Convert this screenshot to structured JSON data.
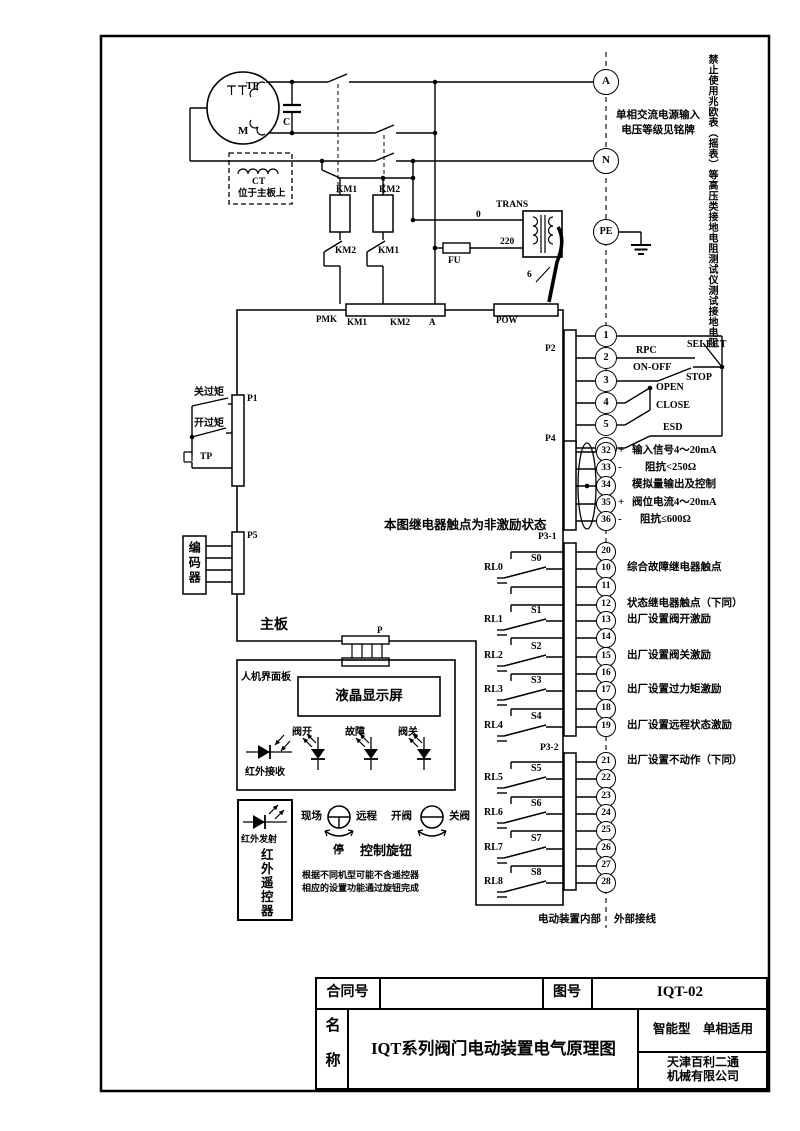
{
  "diagram": {
    "warning_vertical": "禁止使用兆欧表（摇表）等高压类接地电阻测试仪测试接地电阻",
    "supply_line1": "单相交流电源输入",
    "supply_line2": "电压等级见铭牌",
    "relay_state_note": "本图继电器触点为非激励状态",
    "internal_label": "电动装置内部",
    "external_label": "外部接线"
  },
  "terminals_top": {
    "a": "A",
    "n": "N",
    "pe": "PE"
  },
  "motor": {
    "tp": "TP",
    "m": "M",
    "c": "C",
    "ct": "CT",
    "ct_note": "位于主板上"
  },
  "contactors": {
    "km1_coil": "KM1",
    "km2_coil": "KM2",
    "km1_nc": "KM2",
    "km2_nc": "KM1"
  },
  "power": {
    "fu": "FU",
    "tap_0": "0",
    "tap_220": "220",
    "trans": "TRANS",
    "wire_count": "6",
    "pmk": "PMK",
    "pmk_t1": "KM1",
    "pmk_t2": "KM2",
    "pmk_t3": "A",
    "pow": "POW"
  },
  "torque": {
    "p1": "P1",
    "close_torque": "关过矩",
    "open_torque": "开过矩",
    "tp": "TP"
  },
  "encoder": {
    "p5": "P5",
    "name": "编码器"
  },
  "mainboard_label": "主板",
  "p2": {
    "label": "P2",
    "terminals": [
      "1",
      "2",
      "3",
      "4",
      "5",
      "6"
    ],
    "rpc": "RPC",
    "select": "SELECT",
    "on_off": "ON-OFF",
    "stop": "STOP",
    "open": "OPEN",
    "close": "CLOSE",
    "esd": "ESD"
  },
  "p4": {
    "label": "P4",
    "terminals": [
      {
        "num": "32",
        "sign": "+",
        "desc": "输入信号4～20mA"
      },
      {
        "num": "33",
        "sign": "-",
        "desc": "阻抗<250Ω"
      },
      {
        "num": "34",
        "sign": "",
        "desc": "模拟量输出及控制"
      },
      {
        "num": "35",
        "sign": "+",
        "desc": "阀位电流4～20mA"
      },
      {
        "num": "36",
        "sign": "-",
        "desc": "阻抗≤600Ω"
      }
    ]
  },
  "p31": {
    "label": "P3-1",
    "terminals": [
      {
        "num": "20",
        "desc": ""
      },
      {
        "num": "10",
        "desc": "综合故障继电器触点"
      },
      {
        "num": "11",
        "desc": ""
      },
      {
        "num": "12",
        "desc": "状态继电器触点（下同）"
      },
      {
        "num": "13",
        "desc": "出厂设置阀开激励"
      },
      {
        "num": "14",
        "desc": ""
      },
      {
        "num": "15",
        "desc": "出厂设置阀关激励"
      },
      {
        "num": "16",
        "desc": ""
      },
      {
        "num": "17",
        "desc": "出厂设置过力矩激励"
      },
      {
        "num": "18",
        "desc": ""
      },
      {
        "num": "19",
        "desc": "出厂设置远程状态激励"
      }
    ],
    "relays": [
      {
        "name": "RL0",
        "sw": "S0"
      },
      {
        "name": "RL1",
        "sw": "S1"
      },
      {
        "name": "RL2",
        "sw": "S2"
      },
      {
        "name": "RL3",
        "sw": "S3"
      },
      {
        "name": "RL4",
        "sw": "S4"
      }
    ]
  },
  "p32": {
    "label": "P3-2",
    "terminals": [
      {
        "num": "21",
        "desc": "出厂设置不动作（下同）"
      },
      {
        "num": "22",
        "desc": ""
      },
      {
        "num": "23",
        "desc": ""
      },
      {
        "num": "24",
        "desc": ""
      },
      {
        "num": "25",
        "desc": ""
      },
      {
        "num": "26",
        "desc": ""
      },
      {
        "num": "27",
        "desc": ""
      },
      {
        "num": "28",
        "desc": ""
      }
    ],
    "relays": [
      {
        "name": "RL5",
        "sw": "S5"
      },
      {
        "name": "RL6",
        "sw": "S6"
      },
      {
        "name": "RL7",
        "sw": "S7"
      },
      {
        "name": "RL8",
        "sw": "S8"
      }
    ]
  },
  "hmi": {
    "panel": "人机界面板",
    "lcd": "液晶显示屏",
    "p": "P",
    "leds": [
      {
        "label": "阀开"
      },
      {
        "label": "故障"
      },
      {
        "label": "阀关"
      }
    ],
    "ir_receive": "红外接收"
  },
  "remote": {
    "ir_transmit": "红外发射",
    "name_vertical": "红外遥控器",
    "note1": "根据不同机型可能不含遥控器",
    "note2": "相应的设置功能通过旋钮完成"
  },
  "knob": {
    "local": "现场",
    "remote": "远程",
    "stop": "停",
    "open": "开阀",
    "close": "关阀",
    "title": "控制旋钮"
  },
  "titleblock": {
    "contract_label": "合同号",
    "contract_value": "",
    "drawing_label": "图号",
    "drawing_no": "IQT-02",
    "name_label": "名称",
    "title": "IQT系列阀门电动装置电气原理图",
    "variant": "智能型　单相适用",
    "company1": "天津百利二通",
    "company2": "机械有限公司"
  }
}
